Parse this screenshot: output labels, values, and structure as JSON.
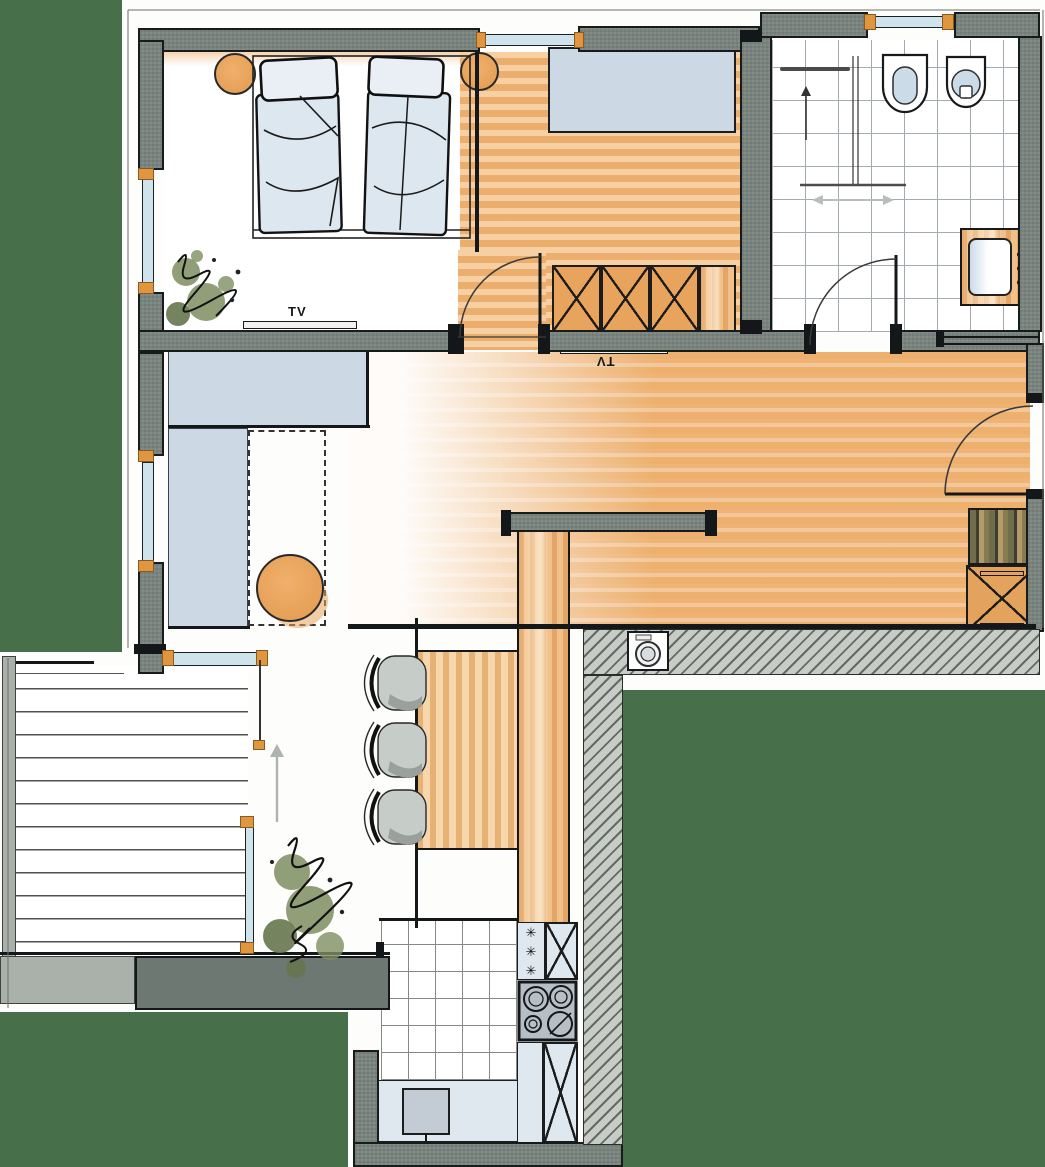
{
  "meta": {
    "type": "architectural-floor-plan",
    "style": "hand-rendered marker sketch of an apartment"
  },
  "palette": {
    "background_green": "#47704a",
    "paper_white": "#fdfdfb",
    "wall_gray": "#79837d",
    "wall_light_gray": "#aab1aa",
    "line_black": "#14171a",
    "floor_orange": "#eaa55f",
    "furniture_blue": "#ccd9e5",
    "glass_blue": "#cfe3ec",
    "plant_green": "#7e8e62",
    "stool_gray": "#c6ccc8",
    "hatch_gray": "#c7ccc6",
    "window_cap_orange": "#e0953f"
  },
  "labels": {
    "bedroom_tv": "TV",
    "living_tv": "TV"
  },
  "icons": {
    "snowflake": "✳"
  },
  "rooms": [
    {
      "name": "bedroom",
      "items": [
        "double-bed",
        "two-pillows",
        "bedside-table-left",
        "bedside-table-right",
        "corner-plant",
        "tv-sideboard"
      ]
    },
    {
      "name": "hallway",
      "items": [
        "wardrobe",
        "x-front-closet",
        "door-to-living"
      ]
    },
    {
      "name": "bathroom",
      "items": [
        "walk-in-shower",
        "towel-rail",
        "entry-arrow",
        "toilet",
        "bidet",
        "washbasin-vanity",
        "door-swing"
      ]
    },
    {
      "name": "living-dining",
      "items": [
        "corner-sofa",
        "dashed-rug",
        "round-coffee-table",
        "tv-board",
        "bar-counter",
        "three-bar-stools",
        "entrance-door",
        "entry-shelf",
        "x-bench"
      ]
    },
    {
      "name": "kitchen",
      "items": [
        "counter-run",
        "freezer",
        "x-cabinet",
        "cooktop-four-burners",
        "sink",
        "tall-x-cabinet"
      ]
    },
    {
      "name": "terrace",
      "items": [
        "wood-decking",
        "glass-railing",
        "sliding-door",
        "entry-arrow",
        "plant"
      ]
    },
    {
      "name": "service",
      "items": [
        "washing-machine-in-wall-niche"
      ]
    }
  ]
}
